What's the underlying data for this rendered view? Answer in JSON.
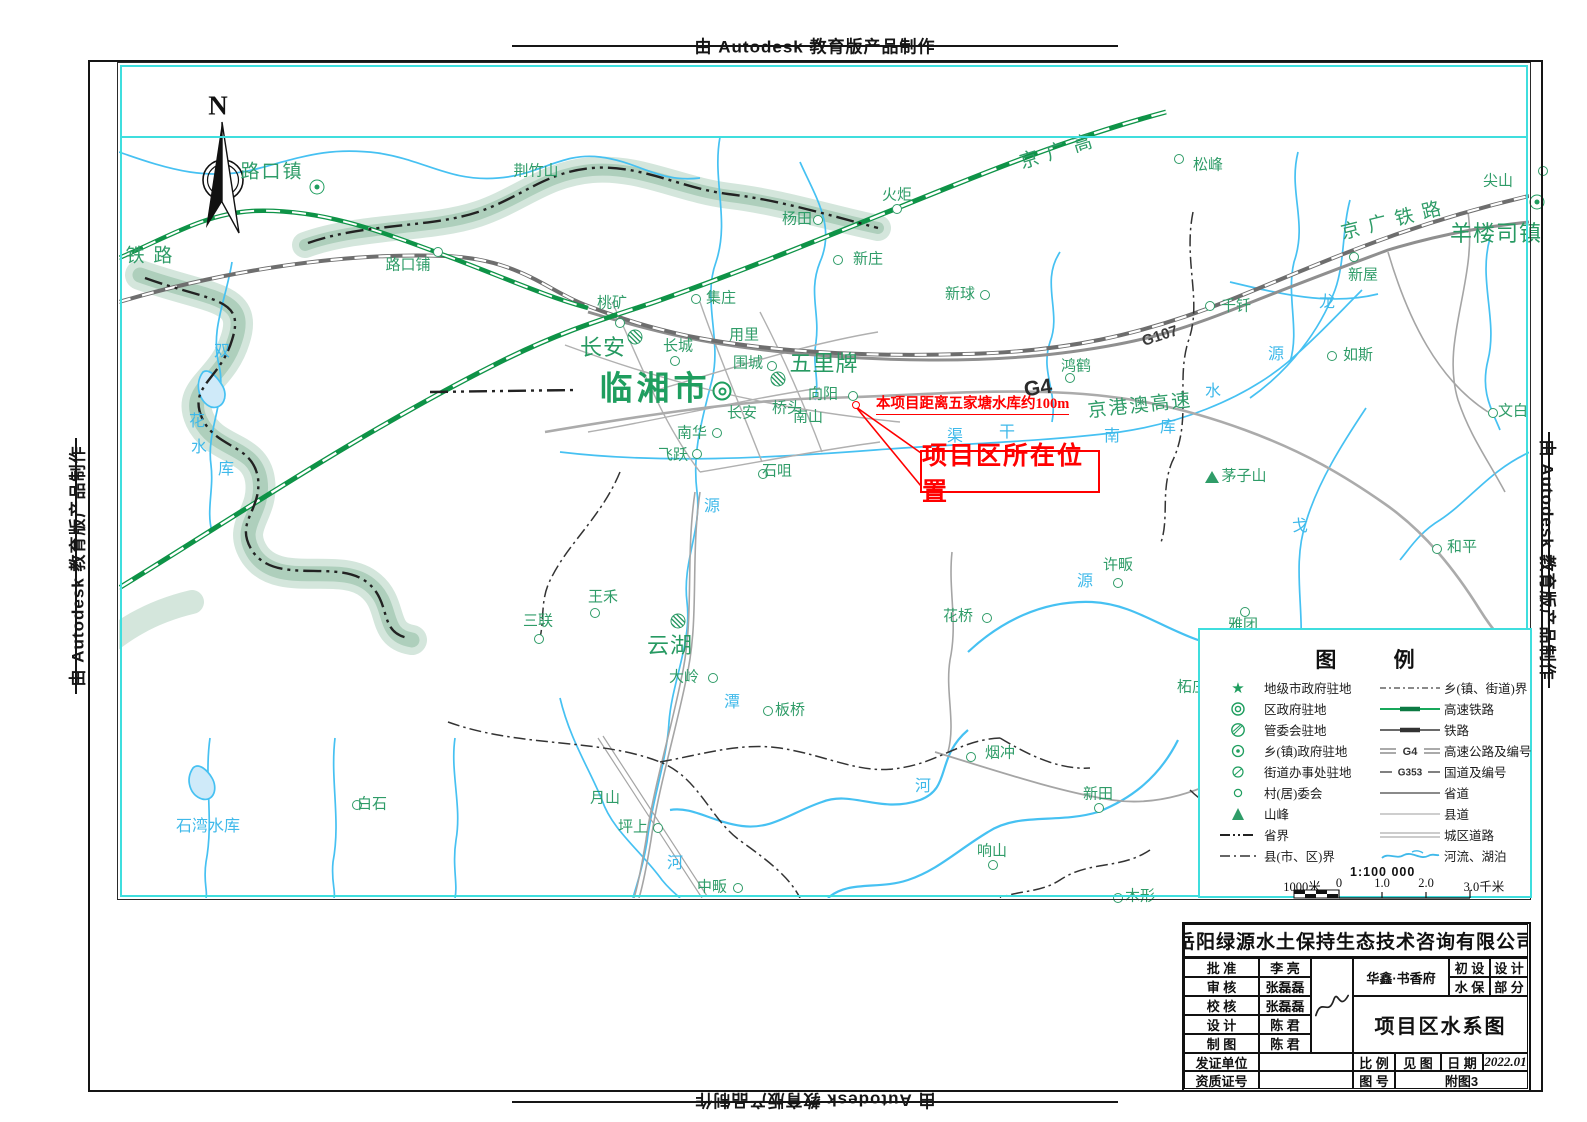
{
  "banner": {
    "text": "由 Autodesk 教育版产品制作"
  },
  "north_label": "N",
  "annotations": {
    "distance_note": "本项目距离五家塘水库约100m",
    "location_box": "项目区所在位置"
  },
  "map_labels": [
    {
      "t": "路口镇",
      "x": 272,
      "y": 172,
      "c": "g-lg"
    },
    {
      "t": "铁  路",
      "x": 150,
      "y": 256,
      "c": "g-lg"
    },
    {
      "t": "路口铺",
      "x": 408,
      "y": 266,
      "c": "g"
    },
    {
      "t": "荆竹山",
      "x": 536,
      "y": 172,
      "c": "g"
    },
    {
      "t": "集庄",
      "x": 721,
      "y": 299,
      "c": "g"
    },
    {
      "t": "桃矿",
      "x": 612,
      "y": 304,
      "c": "g"
    },
    {
      "t": "杨田",
      "x": 797,
      "y": 220,
      "c": "g"
    },
    {
      "t": "火炬",
      "x": 897,
      "y": 196,
      "c": "g"
    },
    {
      "t": "新庄",
      "x": 868,
      "y": 260,
      "c": "g"
    },
    {
      "t": "新球",
      "x": 960,
      "y": 295,
      "c": "g"
    },
    {
      "t": "京 广 高",
      "x": 1057,
      "y": 152,
      "c": "g-lg",
      "r": -17
    },
    {
      "t": "松峰",
      "x": 1208,
      "y": 166,
      "c": "g"
    },
    {
      "t": "尖山",
      "x": 1498,
      "y": 182,
      "c": "g"
    },
    {
      "t": "京 广 铁 路",
      "x": 1392,
      "y": 221,
      "c": "g-lg",
      "r": -14
    },
    {
      "t": "羊楼司镇",
      "x": 1496,
      "y": 234,
      "c": "g-xl2"
    },
    {
      "t": "新屋",
      "x": 1363,
      "y": 276,
      "c": "g"
    },
    {
      "t": "如斯",
      "x": 1358,
      "y": 356,
      "c": "g"
    },
    {
      "t": "千钎",
      "x": 1236,
      "y": 307,
      "c": "g"
    },
    {
      "t": "文白",
      "x": 1513,
      "y": 412,
      "c": "g"
    },
    {
      "t": "鸿鹤",
      "x": 1076,
      "y": 367,
      "c": "g"
    },
    {
      "t": "G107",
      "x": 1160,
      "y": 336,
      "c": "rd",
      "r": -18
    },
    {
      "t": "G4",
      "x": 1038,
      "y": 388,
      "c": "rd-lg",
      "r": -8
    },
    {
      "t": "京港澳高速",
      "x": 1140,
      "y": 406,
      "c": "g-lg",
      "r": -6
    },
    {
      "t": "临湘市",
      "x": 655,
      "y": 390,
      "c": "g-city"
    },
    {
      "t": "长安",
      "x": 603,
      "y": 348,
      "c": "g-xl2"
    },
    {
      "t": "长城",
      "x": 678,
      "y": 347,
      "c": "g"
    },
    {
      "t": "用里",
      "x": 744,
      "y": 336,
      "c": "g"
    },
    {
      "t": "围城",
      "x": 748,
      "y": 364,
      "c": "g"
    },
    {
      "t": "五里牌",
      "x": 824,
      "y": 364,
      "c": "g-xl2"
    },
    {
      "t": "向阳",
      "x": 823,
      "y": 395,
      "c": "g"
    },
    {
      "t": "桥头",
      "x": 787,
      "y": 409,
      "c": "g"
    },
    {
      "t": "长安",
      "x": 742,
      "y": 414,
      "c": "g"
    },
    {
      "t": "南山",
      "x": 808,
      "y": 418,
      "c": "g"
    },
    {
      "t": "南华",
      "x": 692,
      "y": 434,
      "c": "g"
    },
    {
      "t": "飞跃",
      "x": 673,
      "y": 456,
      "c": "g"
    },
    {
      "t": "石咀",
      "x": 777,
      "y": 472,
      "c": "g"
    },
    {
      "t": "茅子山",
      "x": 1244,
      "y": 477,
      "c": "g"
    },
    {
      "t": "和平",
      "x": 1462,
      "y": 548,
      "c": "g"
    },
    {
      "t": "许畈",
      "x": 1118,
      "y": 566,
      "c": "g"
    },
    {
      "t": "花桥",
      "x": 958,
      "y": 617,
      "c": "g"
    },
    {
      "t": "雅团",
      "x": 1243,
      "y": 626,
      "c": "g"
    },
    {
      "t": "柘庄",
      "x": 1192,
      "y": 688,
      "c": "g"
    },
    {
      "t": "三联",
      "x": 538,
      "y": 622,
      "c": "g"
    },
    {
      "t": "王禾",
      "x": 603,
      "y": 598,
      "c": "g"
    },
    {
      "t": "云湖",
      "x": 670,
      "y": 646,
      "c": "g-xl2"
    },
    {
      "t": "大岭",
      "x": 684,
      "y": 678,
      "c": "g"
    },
    {
      "t": "板桥",
      "x": 790,
      "y": 711,
      "c": "g"
    },
    {
      "t": "烟冲",
      "x": 1000,
      "y": 754,
      "c": "g"
    },
    {
      "t": "新田",
      "x": 1098,
      "y": 795,
      "c": "g"
    },
    {
      "t": "响山",
      "x": 992,
      "y": 852,
      "c": "g"
    },
    {
      "t": "木形",
      "x": 1140,
      "y": 897,
      "c": "g"
    },
    {
      "t": "中畈",
      "x": 712,
      "y": 888,
      "c": "g"
    },
    {
      "t": "坪上",
      "x": 633,
      "y": 828,
      "c": "g"
    },
    {
      "t": "月山",
      "x": 605,
      "y": 799,
      "c": "g"
    },
    {
      "t": "白石",
      "x": 372,
      "y": 805,
      "c": "g"
    },
    {
      "t": "石湾水库",
      "x": 208,
      "y": 827,
      "c": "b"
    },
    {
      "t": "双",
      "x": 222,
      "y": 352,
      "c": "b"
    },
    {
      "t": "花",
      "x": 197,
      "y": 422,
      "c": "b"
    },
    {
      "t": "水",
      "x": 199,
      "y": 448,
      "c": "b"
    },
    {
      "t": "库",
      "x": 226,
      "y": 470,
      "c": "b"
    },
    {
      "t": "龙",
      "x": 1327,
      "y": 303,
      "c": "b"
    },
    {
      "t": "源",
      "x": 1276,
      "y": 355,
      "c": "b"
    },
    {
      "t": "水",
      "x": 1213,
      "y": 392,
      "c": "b"
    },
    {
      "t": "库",
      "x": 1168,
      "y": 428,
      "c": "b"
    },
    {
      "t": "南",
      "x": 1112,
      "y": 437,
      "c": "b"
    },
    {
      "t": "干",
      "x": 1007,
      "y": 433,
      "c": "b"
    },
    {
      "t": "渠",
      "x": 955,
      "y": 437,
      "c": "b"
    },
    {
      "t": "源",
      "x": 712,
      "y": 507,
      "c": "b"
    },
    {
      "t": "源",
      "x": 1085,
      "y": 582,
      "c": "b"
    },
    {
      "t": "戈",
      "x": 1300,
      "y": 527,
      "c": "b"
    },
    {
      "t": "潭",
      "x": 732,
      "y": 703,
      "c": "b"
    },
    {
      "t": "河",
      "x": 923,
      "y": 787,
      "c": "b"
    },
    {
      "t": "河",
      "x": 675,
      "y": 864,
      "c": "b"
    }
  ],
  "markers": [
    {
      "k": "town",
      "x": 317,
      "y": 187
    },
    {
      "k": "town",
      "x": 1537,
      "y": 202
    },
    {
      "k": "city",
      "x": 722,
      "y": 391
    },
    {
      "k": "admin",
      "x": 635,
      "y": 337
    },
    {
      "k": "admin",
      "x": 778,
      "y": 379
    },
    {
      "k": "admin",
      "x": 678,
      "y": 621
    },
    {
      "k": "village",
      "x": 438,
      "y": 252
    },
    {
      "k": "village",
      "x": 818,
      "y": 220
    },
    {
      "k": "village",
      "x": 897,
      "y": 209
    },
    {
      "k": "village",
      "x": 838,
      "y": 260
    },
    {
      "k": "village",
      "x": 985,
      "y": 295
    },
    {
      "k": "village",
      "x": 1179,
      "y": 159
    },
    {
      "k": "village",
      "x": 1543,
      "y": 171
    },
    {
      "k": "village",
      "x": 1354,
      "y": 257
    },
    {
      "k": "village",
      "x": 1332,
      "y": 356
    },
    {
      "k": "village",
      "x": 1210,
      "y": 306
    },
    {
      "k": "village",
      "x": 1493,
      "y": 413
    },
    {
      "k": "village",
      "x": 1070,
      "y": 378
    },
    {
      "k": "village",
      "x": 696,
      "y": 299
    },
    {
      "k": "village",
      "x": 620,
      "y": 323
    },
    {
      "k": "village",
      "x": 675,
      "y": 361
    },
    {
      "k": "village",
      "x": 772,
      "y": 366
    },
    {
      "k": "village",
      "x": 853,
      "y": 396
    },
    {
      "k": "village",
      "x": 717,
      "y": 433
    },
    {
      "k": "village",
      "x": 697,
      "y": 454
    },
    {
      "k": "village",
      "x": 763,
      "y": 474
    },
    {
      "k": "village",
      "x": 1437,
      "y": 549
    },
    {
      "k": "village",
      "x": 1118,
      "y": 583
    },
    {
      "k": "village",
      "x": 987,
      "y": 618
    },
    {
      "k": "village",
      "x": 1245,
      "y": 612
    },
    {
      "k": "village",
      "x": 539,
      "y": 639
    },
    {
      "k": "village",
      "x": 595,
      "y": 613
    },
    {
      "k": "village",
      "x": 713,
      "y": 678
    },
    {
      "k": "village",
      "x": 768,
      "y": 711
    },
    {
      "k": "village",
      "x": 971,
      "y": 757
    },
    {
      "k": "village",
      "x": 1099,
      "y": 808
    },
    {
      "k": "village",
      "x": 993,
      "y": 865
    },
    {
      "k": "village",
      "x": 1118,
      "y": 898
    },
    {
      "k": "village",
      "x": 738,
      "y": 888
    },
    {
      "k": "village",
      "x": 658,
      "y": 828
    },
    {
      "k": "village",
      "x": 357,
      "y": 805
    },
    {
      "k": "peak",
      "x": 1212,
      "y": 477
    },
    {
      "k": "redpoint",
      "x": 856,
      "y": 405
    }
  ],
  "legend": {
    "title": "图 例",
    "left": [
      {
        "icon": "star",
        "label": "地级市政府驻地"
      },
      {
        "icon": "dcircle",
        "label": "区政府驻地"
      },
      {
        "icon": "hcircle",
        "label": "管委会驻地"
      },
      {
        "icon": "dotcircle",
        "label": "乡(镇)政府驻地"
      },
      {
        "icon": "hcircle2",
        "label": "街道办事处驻地"
      },
      {
        "icon": "circle",
        "label": "村(居)委会"
      },
      {
        "icon": "tri",
        "label": "山峰"
      },
      {
        "icon": "provline",
        "label": "省界"
      },
      {
        "icon": "countyline",
        "label": "县(市、区)界"
      }
    ],
    "right": [
      {
        "icon": "townline",
        "label": "乡(镇、街道)界"
      },
      {
        "icon": "hsr",
        "label": "高速铁路"
      },
      {
        "icon": "rail",
        "label": "铁路"
      },
      {
        "icon": "expwy",
        "label": "高速公路及编号",
        "tag": "G4"
      },
      {
        "icon": "natl",
        "label": "国道及编号",
        "tag": "G353"
      },
      {
        "icon": "provroad",
        "label": "省道"
      },
      {
        "icon": "countyroad",
        "label": "县道"
      },
      {
        "icon": "urbanroad",
        "label": "城区道路"
      },
      {
        "icon": "river",
        "label": "河流、湖泊"
      }
    ],
    "scale": {
      "ratio": "1:100 000",
      "ticks": [
        {
          "t": "1000米",
          "x": 102
        },
        {
          "t": "0",
          "x": 139
        },
        {
          "t": "1.0",
          "x": 182
        },
        {
          "t": "2.0",
          "x": 226
        },
        {
          "t": "3.0千米",
          "x": 284
        }
      ]
    }
  },
  "titleblock": {
    "company": "岳阳绿源水土保持生态技术咨询有限公司",
    "rows": [
      {
        "label": "批 准",
        "value": "李 亮"
      },
      {
        "label": "审 核",
        "value": "张磊磊"
      },
      {
        "label": "校 核",
        "value": "张磊磊"
      },
      {
        "label": "设 计",
        "value": "陈 君"
      },
      {
        "label": "制 图",
        "value": "陈 君"
      }
    ],
    "project": "华鑫·书香府",
    "stage": [
      [
        "初 设",
        "设 计"
      ],
      [
        "水 保",
        "部 分"
      ]
    ],
    "drawing_title": "项目区水系图",
    "license_label": "发证单位",
    "cert_label": "资质证号",
    "scale_label": "比 例",
    "scale_value": "见 图",
    "date_label": "日 期",
    "date_value": "2022.01",
    "fig_label": "图 号",
    "fig_value": "附图3"
  }
}
